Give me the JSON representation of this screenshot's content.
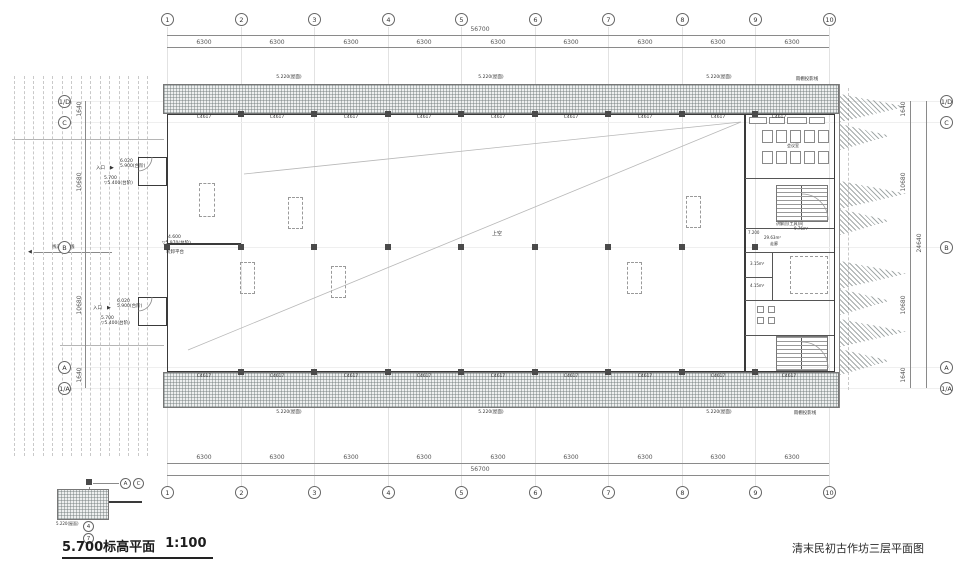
{
  "titles": {
    "plan": "5.700标高平面",
    "scale": "1:100",
    "sheet": "清末民初古作坊三层平面图"
  },
  "axes": {
    "cols": [
      "1",
      "2",
      "3",
      "4",
      "5",
      "6",
      "7",
      "8",
      "9",
      "10"
    ],
    "rows": [
      "1/D",
      "C",
      "B",
      "A",
      "1/A"
    ]
  },
  "dims": {
    "bay": "6300",
    "total_w": "56700",
    "eave": "1640",
    "half": "10680",
    "total_h": "24640"
  },
  "windows": {
    "tag": "C4617"
  },
  "ann": {
    "roof_elev": "5.220(屋面)",
    "canopy": "雨棚投影线",
    "void_label": "上空",
    "entrance": "入口",
    "walkway": "栈道投影线",
    "platform": "装卸平台",
    "p_elev1": "4.600",
    "p_elev2": "▽5.970(台阶)",
    "e1a": "6.020",
    "e1b": "5.900(台阶)",
    "e2a": "5.700",
    "e2b": "▽5.400(台阶)",
    "corridor_elev": "7.200"
  },
  "rooms": {
    "meeting": "会议室",
    "guide": "讲解员(工具)间",
    "guide_area": "9.76m²",
    "corridor": "走廊",
    "corridor_area": "29.63m²",
    "wc1": "3.15m²",
    "wc2": "4.15m²"
  }
}
